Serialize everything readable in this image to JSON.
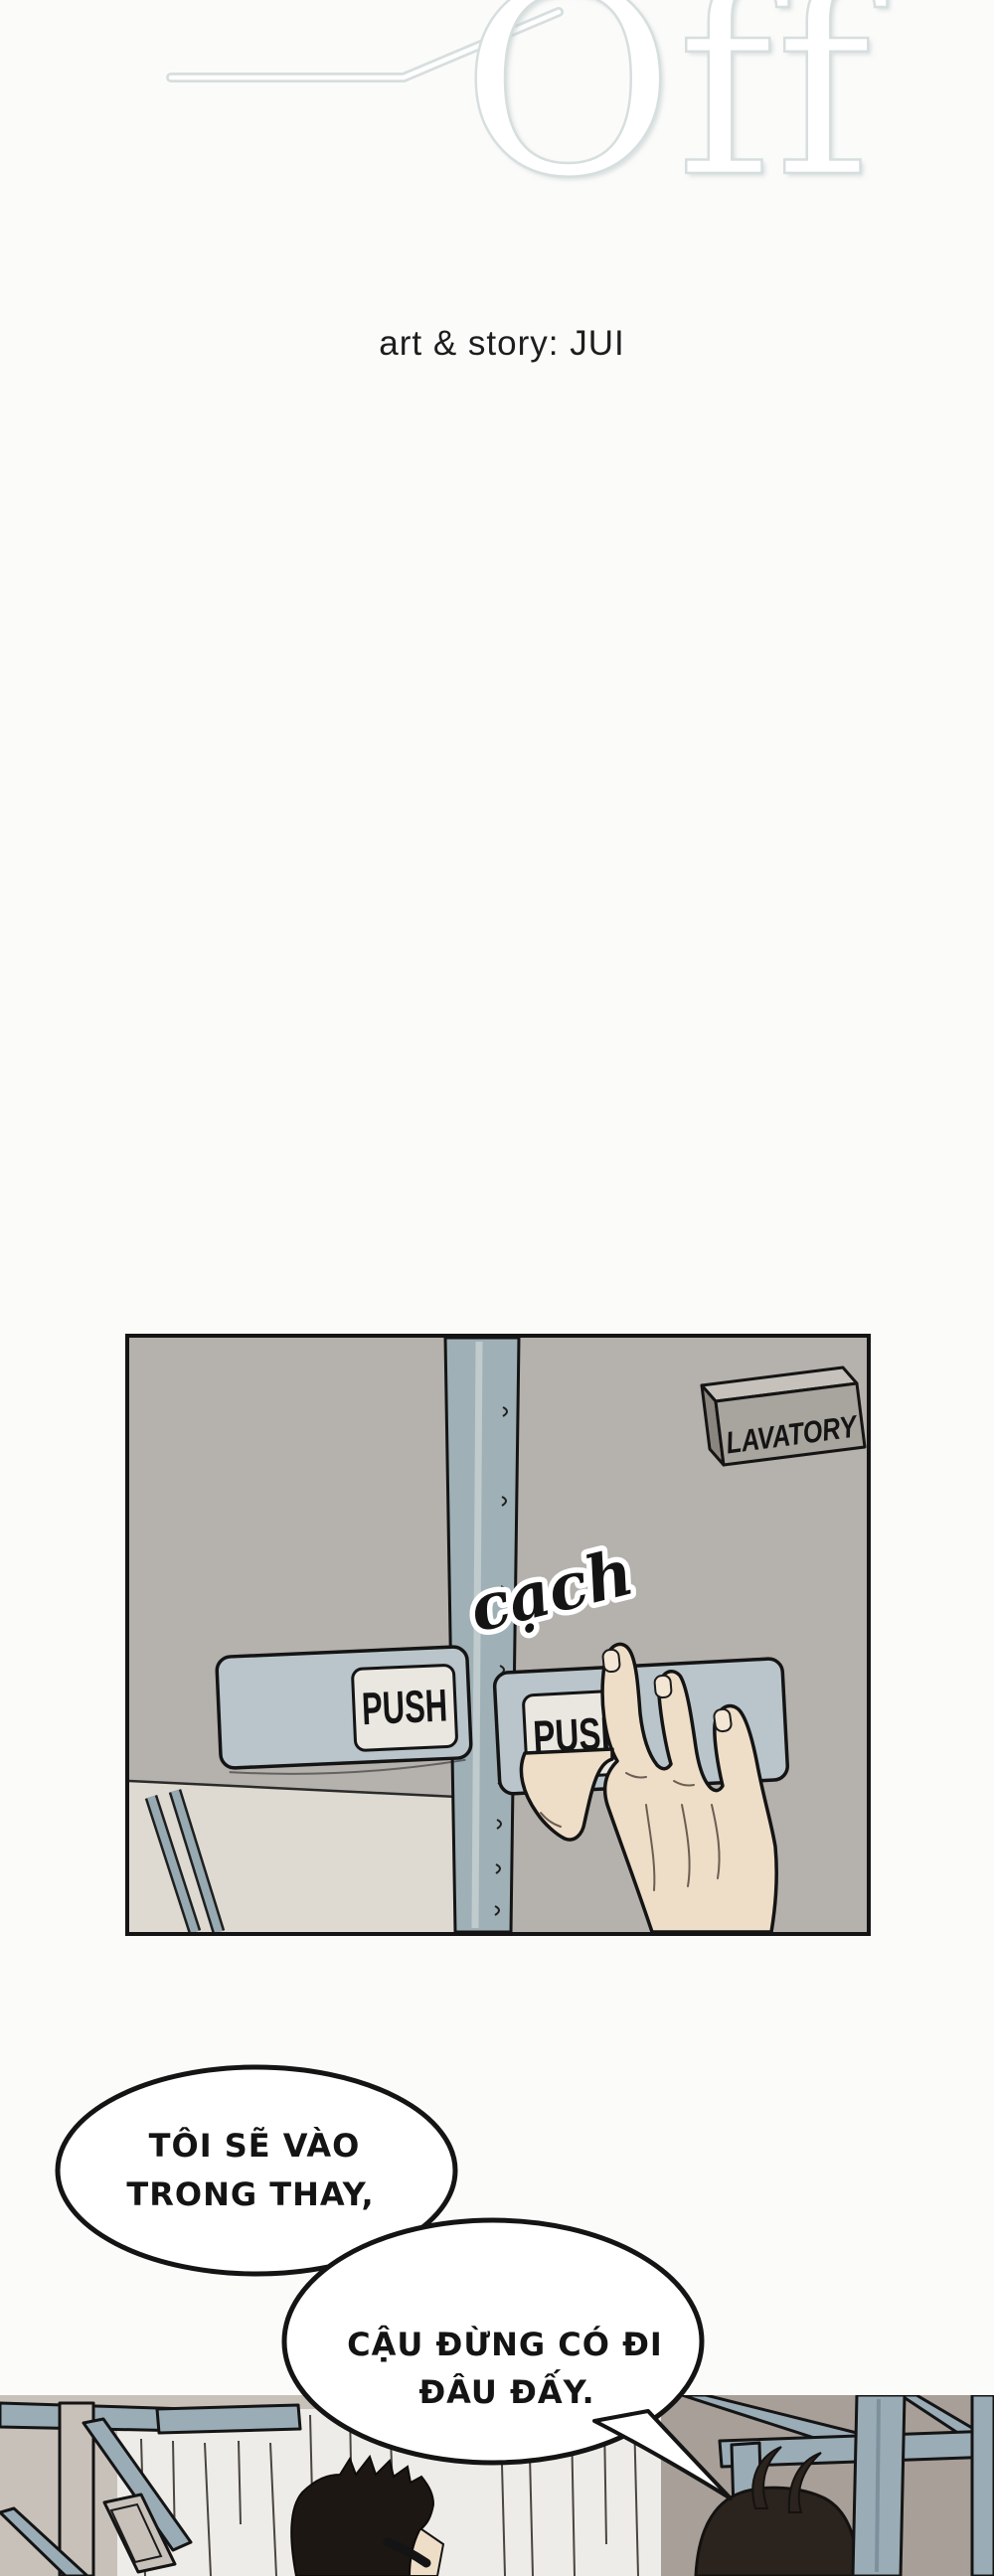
{
  "title": {
    "text": "Off",
    "credit": "art & story: JUI"
  },
  "panel_lavatory": {
    "sign": "LAVATORY",
    "sfx": "cạch",
    "push_left": "PUSH",
    "push_right": "PUSH"
  },
  "dialogue": {
    "bubble1": {
      "line1": "TÔI SẼ VÀO",
      "line2": "TRONG THAY,"
    },
    "bubble2": {
      "line1": "CẬU ĐỪNG CÓ ĐI",
      "line2": "ĐÂU ĐẤY."
    }
  },
  "palette": {
    "page_bg": "#fbfbfa",
    "ink": "#141414",
    "title_stroke": "#d7dede",
    "wall": "#b5b1ac",
    "door_strip": "#9fb0b6",
    "strip_hi": "#c6d0d2",
    "plate": "#b9c5cb",
    "plate_label": "#eae7e1",
    "lower_door": "#dedad2",
    "sign_face": "#a8a49e",
    "sign_top": "#c6c2bb",
    "sign_side": "#8a867f",
    "skin": "#eeddc7",
    "nail": "#f3e6d4",
    "beam": "#9aacb6",
    "curtain": "#eeece8",
    "left_wall": "#c8c1b9",
    "right_wall": "#a79f98",
    "hair_dark": "#1c1713",
    "hair_brown": "#2b231d",
    "bubble_fill": "#ffffff"
  }
}
